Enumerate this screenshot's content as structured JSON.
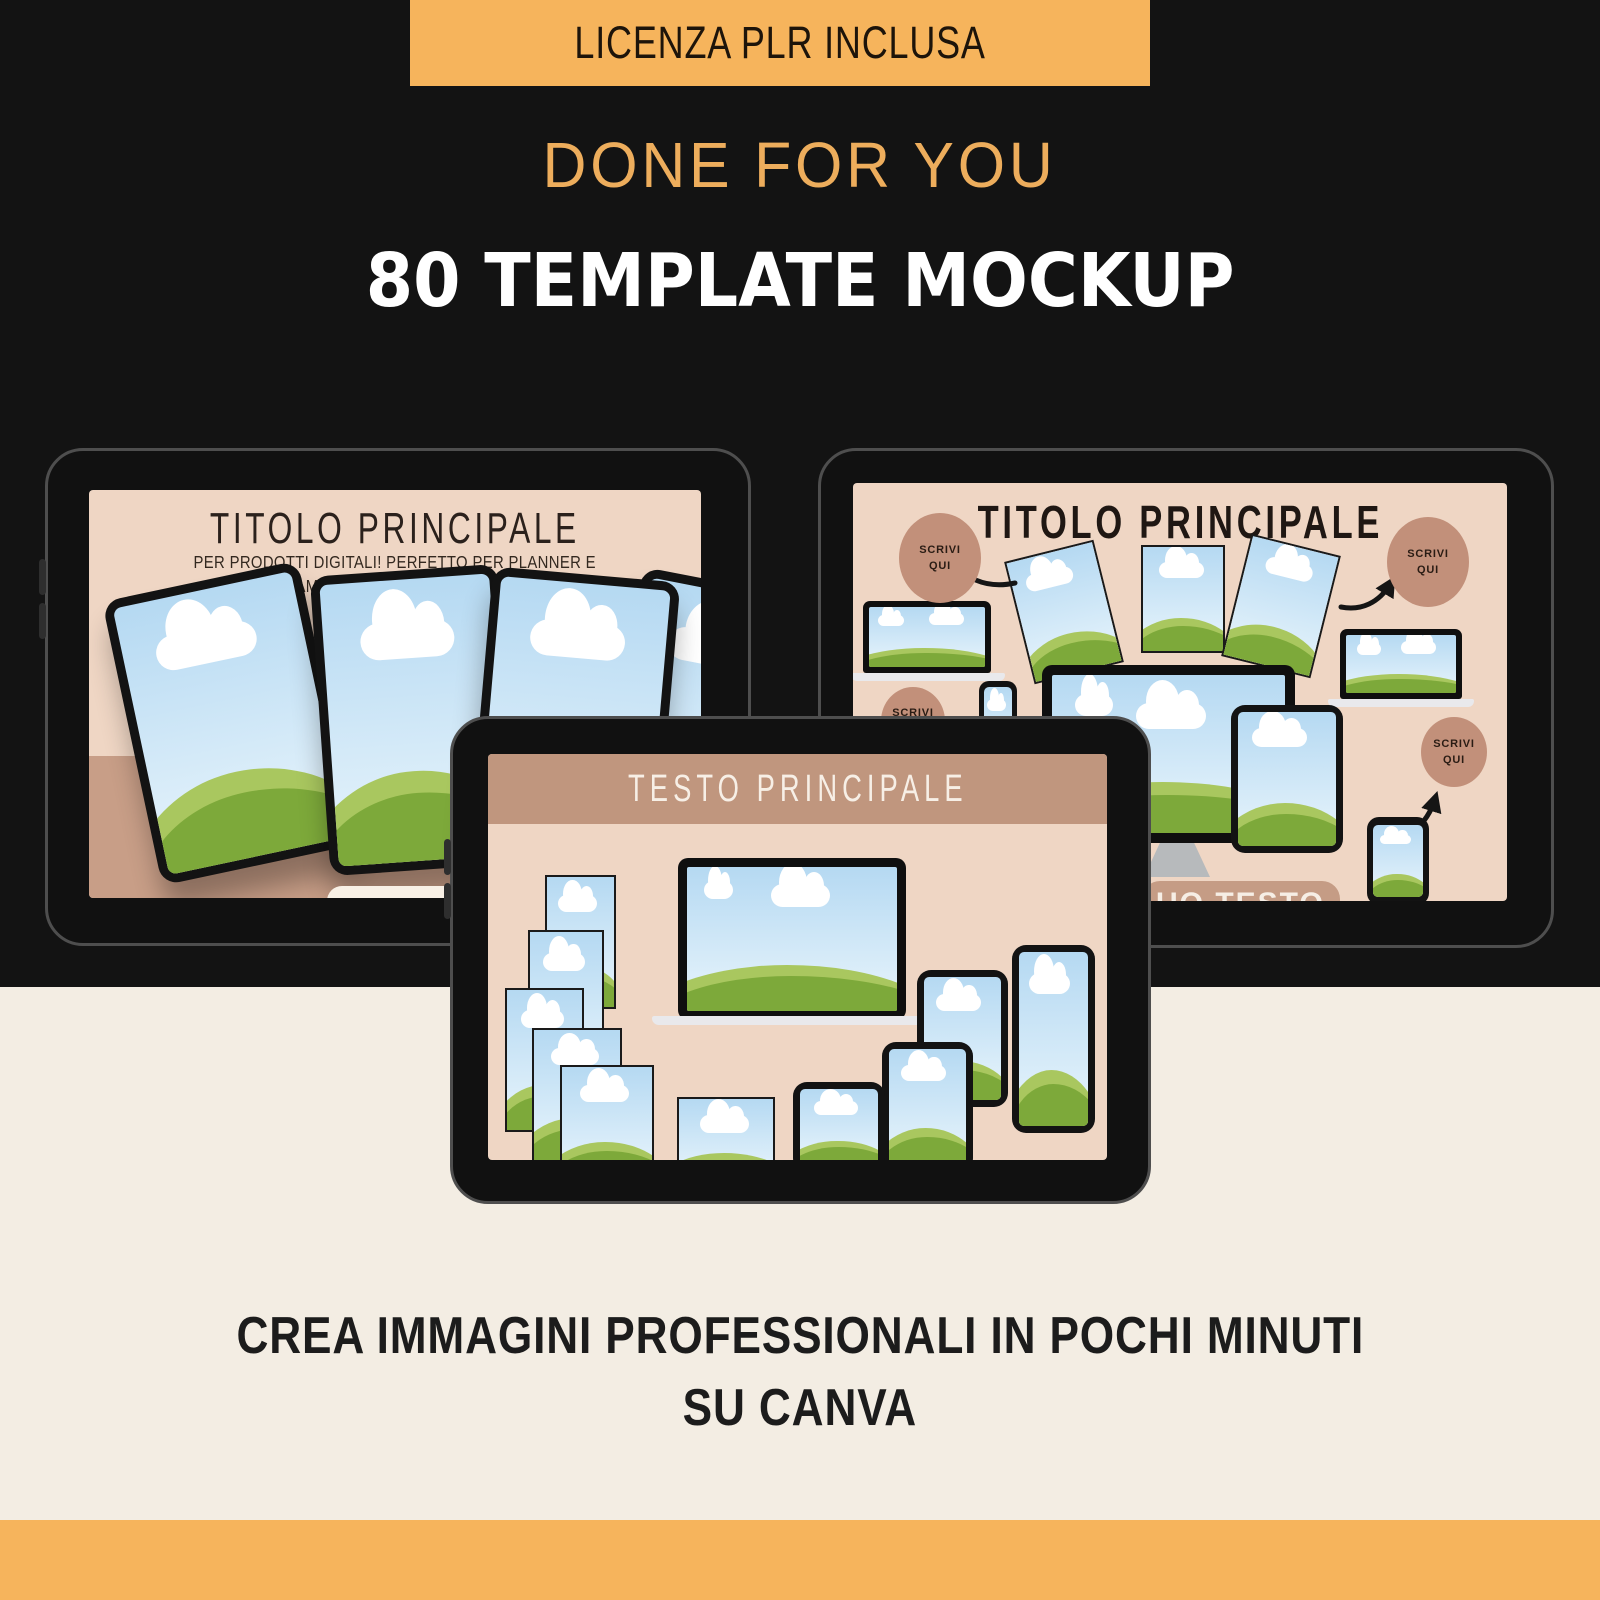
{
  "top": {
    "banner_label": "LICENZA PLR INCLUSA",
    "tagline": "DONE FOR YOU",
    "headline": "80 TEMPLATE MOCKUP"
  },
  "mockup_left": {
    "title": "TITOLO PRINCIPALE",
    "subtitle_line1": "PER PRODOTTI DIGITALI! PERFETTO PER PLANNER E",
    "subtitle_line2": "STAMPABILI, FORMATO 8,5 x 11."
  },
  "mockup_right": {
    "title": "TITOLO PRINCIPALE",
    "badge": {
      "line1": "SCRIVI",
      "line2": "QUI"
    },
    "bottom_banner_text": "UO TESTO"
  },
  "mockup_center": {
    "title": "TESTO PRINCIPALE"
  },
  "footer": {
    "line1": "CREA IMMAGINI PROFESSIONALI IN POCHI MINUTI",
    "line2": "SU CANVA"
  },
  "colors": {
    "accent_orange": "#F6B45C",
    "background_black": "#131313",
    "background_cream": "#F3EDE3",
    "screen_peach": "#EFD6C4",
    "band_tan": "#C89E87",
    "badge_brown": "#C2907A",
    "sky_top": "#B5D9F2",
    "sky_bottom": "#E9F5FC",
    "hill_light": "#A9C75F",
    "hill_dark": "#7DA93A"
  }
}
